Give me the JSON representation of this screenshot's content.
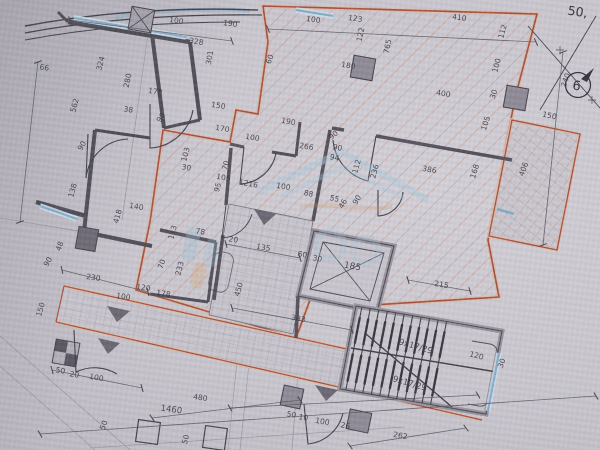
{
  "document": {
    "kind": "architectural floor plan (photographed blueprint)",
    "corner_dimension": "50,",
    "grid_marker": {
      "number": "6"
    }
  },
  "colors": {
    "paper": "#cac7cf",
    "line_dark": "#45434d",
    "apartment_red": "#a8523c",
    "hatch_red": "#c28a78",
    "window_blue": "#84aec9",
    "tile_gray": "#8d8a95",
    "watermark_blue": "#a8c9dc",
    "watermark_orange": "#d8a878"
  },
  "dim_labels": [
    {
      "t": "100",
      "x": 176,
      "y": 23,
      "r": 8
    },
    {
      "t": "190",
      "x": 230,
      "y": 26,
      "r": 8
    },
    {
      "t": "328",
      "x": 196,
      "y": 44,
      "r": 9
    },
    {
      "t": "301",
      "x": 212,
      "y": 58,
      "r": -80
    },
    {
      "t": "324",
      "x": 103,
      "y": 64,
      "r": -75
    },
    {
      "t": "280",
      "x": 130,
      "y": 81,
      "r": -78
    },
    {
      "t": "66",
      "x": 44,
      "y": 70,
      "r": 9
    },
    {
      "t": "562",
      "x": 77,
      "y": 106,
      "r": -75
    },
    {
      "t": "38",
      "x": 128,
      "y": 112,
      "r": 9
    },
    {
      "t": "90",
      "x": 84,
      "y": 147,
      "r": -60
    },
    {
      "t": "178",
      "x": 155,
      "y": 94,
      "r": 9
    },
    {
      "t": "90",
      "x": 163,
      "y": 119,
      "r": -55
    },
    {
      "t": "138",
      "x": 75,
      "y": 191,
      "r": -75
    },
    {
      "t": "140",
      "x": 136,
      "y": 209,
      "r": 9
    },
    {
      "t": "418",
      "x": 120,
      "y": 217,
      "r": -75
    },
    {
      "t": "48",
      "x": 62,
      "y": 247,
      "r": -70
    },
    {
      "t": "90",
      "x": 50,
      "y": 263,
      "r": -60
    },
    {
      "t": "150",
      "x": 43,
      "y": 310,
      "r": -75
    },
    {
      "t": "230",
      "x": 93,
      "y": 280,
      "r": 9
    },
    {
      "t": "100",
      "x": 123,
      "y": 299,
      "r": 9
    },
    {
      "t": "120",
      "x": 143,
      "y": 290,
      "r": 9
    },
    {
      "t": "178",
      "x": 163,
      "y": 296,
      "r": 9
    },
    {
      "t": "50",
      "x": 60,
      "y": 373,
      "r": 10
    },
    {
      "t": "20",
      "x": 74,
      "y": 377,
      "r": 10
    },
    {
      "t": "100",
      "x": 96,
      "y": 380,
      "r": 10
    },
    {
      "t": "70",
      "x": 164,
      "y": 265,
      "r": -70
    },
    {
      "t": "233",
      "x": 182,
      "y": 269,
      "r": -75
    },
    {
      "t": "113",
      "x": 175,
      "y": 233,
      "r": -75
    },
    {
      "t": "78",
      "x": 200,
      "y": 234,
      "r": 9
    },
    {
      "t": "20",
      "x": 233,
      "y": 242,
      "r": 9
    },
    {
      "t": "135",
      "x": 263,
      "y": 250,
      "r": 9
    },
    {
      "t": "450",
      "x": 241,
      "y": 290,
      "r": -75
    },
    {
      "t": "383",
      "x": 298,
      "y": 321,
      "r": 10
    },
    {
      "t": "95",
      "x": 220,
      "y": 188,
      "r": -75
    },
    {
      "t": "60",
      "x": 302,
      "y": 257,
      "r": 10
    },
    {
      "t": "30",
      "x": 317,
      "y": 261,
      "r": 10
    },
    {
      "t": "185",
      "x": 352,
      "y": 269,
      "r": 10,
      "s": 9
    },
    {
      "t": "215",
      "x": 441,
      "y": 287,
      "r": 10
    },
    {
      "t": "120",
      "x": 476,
      "y": 358,
      "r": 14
    },
    {
      "t": "30",
      "x": 504,
      "y": 364,
      "r": -70
    },
    {
      "t": "262",
      "x": 400,
      "y": 438,
      "r": 10
    },
    {
      "t": "50",
      "x": 291,
      "y": 417,
      "r": 10
    },
    {
      "t": "10",
      "x": 303,
      "y": 420,
      "r": 10
    },
    {
      "t": "100",
      "x": 322,
      "y": 424,
      "r": 10
    },
    {
      "t": "26",
      "x": 345,
      "y": 428,
      "r": 10
    },
    {
      "t": "9x17/29",
      "x": 415,
      "y": 349,
      "r": 16,
      "s": 8.5
    },
    {
      "t": "9x17/29",
      "x": 409,
      "y": 386,
      "r": 16,
      "s": 8.5
    },
    {
      "t": "1460",
      "x": 171,
      "y": 412,
      "r": 8,
      "s": 8.5
    },
    {
      "t": "480",
      "x": 200,
      "y": 400,
      "r": 8
    },
    {
      "t": "50",
      "x": 106,
      "y": 426,
      "r": -70
    },
    {
      "t": "50",
      "x": 188,
      "y": 440,
      "r": -75
    },
    {
      "t": "112",
      "x": 505,
      "y": 32,
      "r": -75
    },
    {
      "t": "100",
      "x": 499,
      "y": 66,
      "r": -75
    },
    {
      "t": "30",
      "x": 496,
      "y": 95,
      "r": -72
    },
    {
      "t": "105",
      "x": 488,
      "y": 124,
      "r": -72
    },
    {
      "t": "168",
      "x": 477,
      "y": 172,
      "r": -72
    },
    {
      "t": "406",
      "x": 526,
      "y": 170,
      "r": -70
    },
    {
      "t": "150",
      "x": 549,
      "y": 118,
      "r": 12
    },
    {
      "t": "240",
      "x": 568,
      "y": 81,
      "r": -70
    },
    {
      "t": "400",
      "x": 443,
      "y": 96,
      "r": 9
    },
    {
      "t": "386",
      "x": 429,
      "y": 172,
      "r": 10
    },
    {
      "t": "100",
      "x": 313,
      "y": 22,
      "r": 8
    },
    {
      "t": "123",
      "x": 355,
      "y": 21,
      "r": 8
    },
    {
      "t": "410",
      "x": 459,
      "y": 20,
      "r": 8
    },
    {
      "t": "122",
      "x": 363,
      "y": 35,
      "r": -78
    },
    {
      "t": "765",
      "x": 390,
      "y": 47,
      "r": -78
    },
    {
      "t": "180",
      "x": 348,
      "y": 68,
      "r": 9
    },
    {
      "t": "60",
      "x": 272,
      "y": 60,
      "r": -70
    },
    {
      "t": "90",
      "x": 337,
      "y": 150,
      "r": 12
    },
    {
      "t": "94",
      "x": 334,
      "y": 160,
      "r": 12
    },
    {
      "t": "112",
      "x": 359,
      "y": 167,
      "r": -75
    },
    {
      "t": "236",
      "x": 377,
      "y": 172,
      "r": -75
    },
    {
      "t": "266",
      "x": 306,
      "y": 149,
      "r": 10
    },
    {
      "t": "88",
      "x": 308,
      "y": 196,
      "r": 12
    },
    {
      "t": "55",
      "x": 334,
      "y": 201,
      "r": 12
    },
    {
      "t": "46",
      "x": 345,
      "y": 205,
      "r": -60
    },
    {
      "t": "90",
      "x": 359,
      "y": 201,
      "r": -60
    },
    {
      "t": "105",
      "x": 223,
      "y": 180,
      "r": 10
    },
    {
      "t": "1216",
      "x": 248,
      "y": 186,
      "r": 10
    },
    {
      "t": "100",
      "x": 283,
      "y": 189,
      "r": 10
    },
    {
      "t": "70",
      "x": 228,
      "y": 166,
      "r": -75
    },
    {
      "t": "30",
      "x": 186,
      "y": 170,
      "r": 10
    },
    {
      "t": "103",
      "x": 188,
      "y": 155,
      "r": -75
    },
    {
      "t": "150",
      "x": 218,
      "y": 108,
      "r": 9
    },
    {
      "t": "170",
      "x": 222,
      "y": 131,
      "r": 9
    },
    {
      "t": "190",
      "x": 288,
      "y": 124,
      "r": 10
    },
    {
      "t": "100",
      "x": 252,
      "y": 140,
      "r": 10
    },
    {
      "t": "90",
      "x": 335,
      "y": 137,
      "r": -40
    }
  ]
}
